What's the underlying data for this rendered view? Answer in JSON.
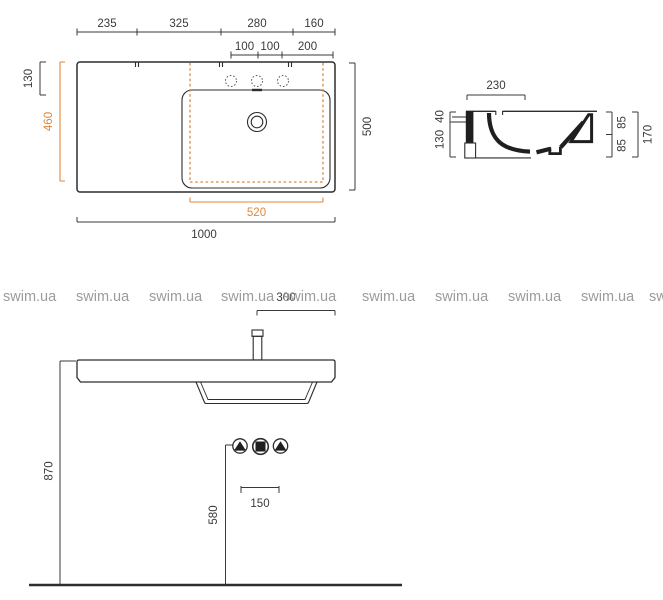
{
  "watermark": {
    "text": "swim.ua",
    "color": "#9b9b9b"
  },
  "colors": {
    "line": "#3a3a3a",
    "drawing": "#2d2d2d",
    "accent_orange": "#e0873b",
    "watermark_gray": "#9b9b9b"
  },
  "plan_view": {
    "width_segments": [
      "235",
      "325",
      "280",
      "160"
    ],
    "tap_hole_segments": [
      "100",
      "100",
      "200"
    ],
    "ledge_depth": "130",
    "cutout_depth": "460",
    "total_depth": "500",
    "cutout_width": "520",
    "total_width": "1000"
  },
  "section_view": {
    "rim_width": "230",
    "deck_thickness": "40",
    "front_height": "130",
    "rear_upper": "85",
    "rear_lower": "85",
    "total_height": "170"
  },
  "front_view": {
    "tap_to_edge": "300",
    "rim_height": "870",
    "outlet_height": "580",
    "supply_spacing": "150"
  }
}
